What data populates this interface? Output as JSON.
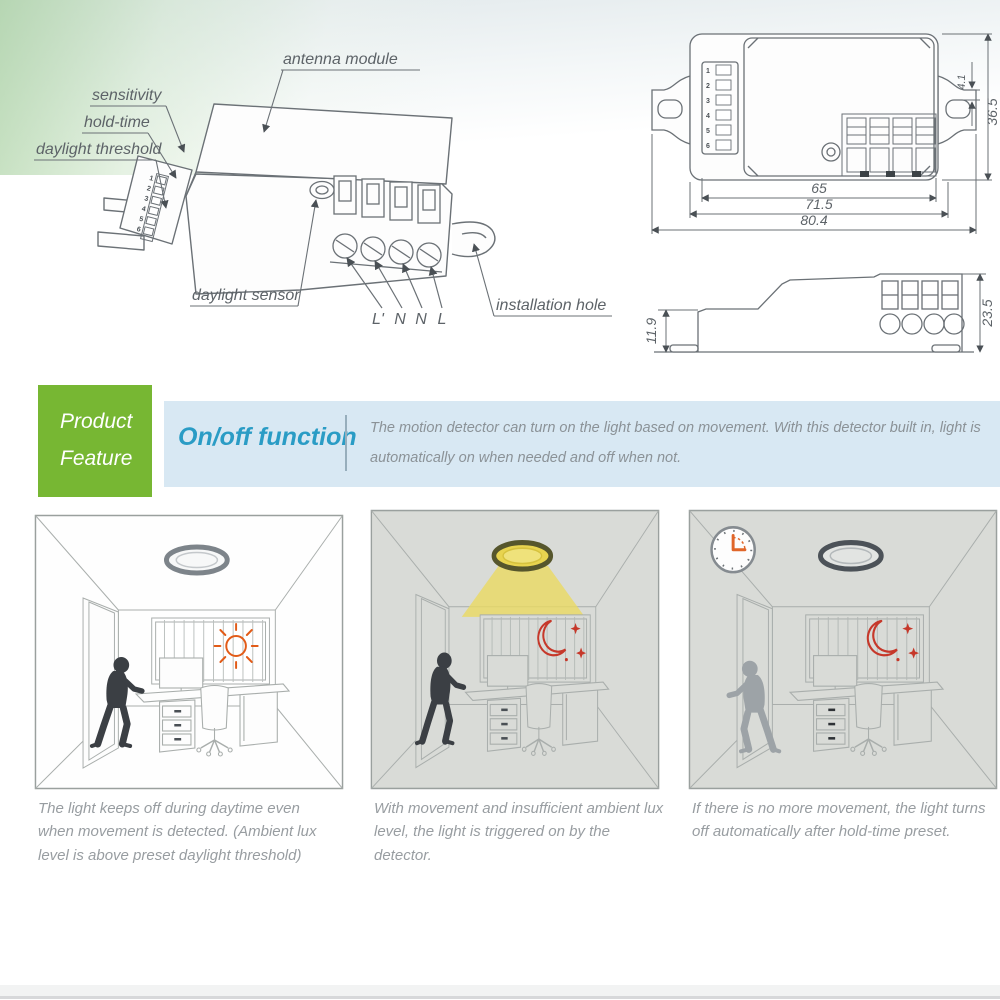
{
  "colors": {
    "accent_green": "#77b733",
    "banner_blue": "#d8e8f3",
    "heading_teal": "#2a9cc5",
    "body_text_gray": "#8b9297",
    "caption_gray": "#989da1",
    "drawing_line": "#6b7176",
    "sun_orange": "#e25b17",
    "moon_red": "#c6382a",
    "lamp_yellow": "#e8d44f",
    "night_room_gray": "#d9dbd7",
    "clock_hand_orange": "#e0662a"
  },
  "diagram": {
    "iso": {
      "antenna_module": "antenna module",
      "sensitivity": "sensitivity",
      "hold_time": "hold-time",
      "daylight_threshold": "daylight threshold",
      "daylight_sensor": "daylight sensor",
      "installation_hole": "installation hole",
      "wire_terminals": [
        "L'",
        "N",
        "N",
        "L"
      ],
      "dip_numbers": [
        "1",
        "2",
        "3",
        "4",
        "5",
        "6"
      ]
    },
    "top_view": {
      "dip_numbers": [
        "1",
        "2",
        "3",
        "4",
        "5",
        "6"
      ],
      "width_inner": "65",
      "width_mid": "71.5",
      "width_outer": "80.4",
      "height": "36.5",
      "ear_offset": "4.1"
    },
    "side_view": {
      "front_height": "11.9",
      "overall_height": "23.5"
    }
  },
  "feature_banner": {
    "tag": {
      "line1": "Product",
      "line2": "Feature"
    },
    "heading": "On/off function",
    "description": {
      "line1": "The motion detector can turn on the light based on movement. With this detector built in, light is",
      "line2": "automatically on when needed and off when not."
    }
  },
  "scenes": [
    {
      "id": "daytime-movement-light-off",
      "ambient": "day",
      "lamp": "off",
      "caption": "The light keeps off during daytime even when movement is detected. (Ambient lux level is above preset daylight threshold)"
    },
    {
      "id": "night-movement-light-on",
      "ambient": "night",
      "lamp": "on",
      "caption": "With movement and insufficient ambient lux level, the light is triggered on by the detector."
    },
    {
      "id": "no-movement-light-off",
      "ambient": "night",
      "lamp": "off",
      "caption": "If there is no more movement, the light turns off automatically after hold-time preset."
    }
  ]
}
